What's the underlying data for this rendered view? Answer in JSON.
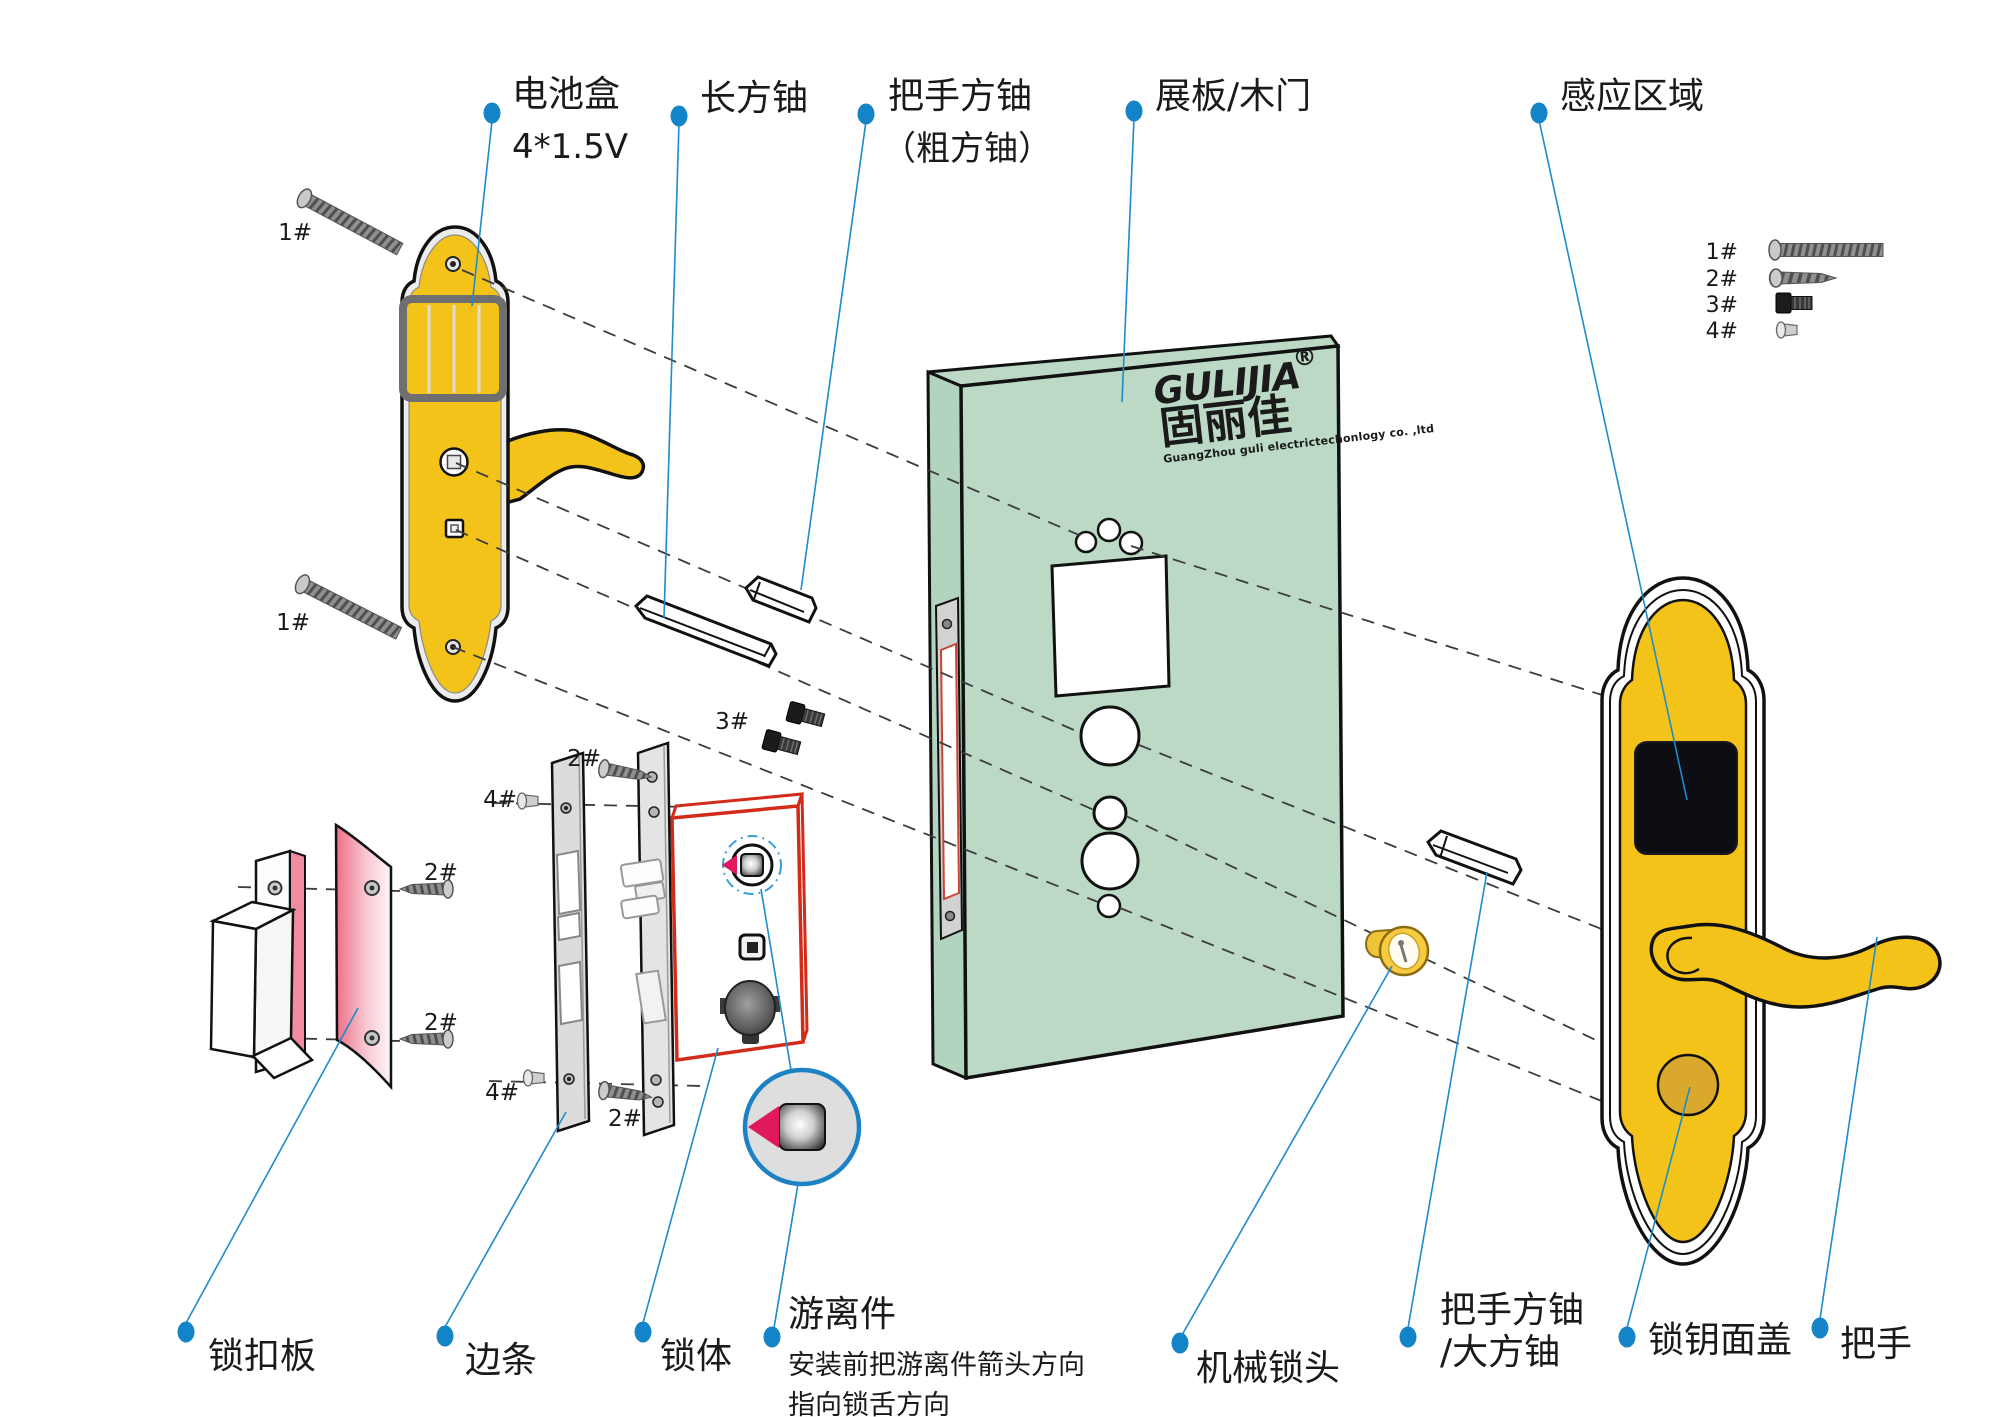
{
  "brand": {
    "name_en": "GULIJIA",
    "reg": "®",
    "name_cn": "固丽佳",
    "company": "GuangZhou guli electrictechonlogy co. ,ltd"
  },
  "labels": {
    "battery_line1": "电池盒",
    "battery_line2": "4*1.5V",
    "long_shaft": "长方铀",
    "handle_shaft_line1": "把手方铀",
    "handle_shaft_line2": "（粗方铀）",
    "door": "展板/木门",
    "sensing_area": "感应区域",
    "strike_plate": "锁扣板",
    "edge_strip": "边条",
    "lock_body": "锁体",
    "floating_title": "游离件",
    "floating_note1": "安装前把游离件箭头方向",
    "floating_note2": "指向锁舌方向",
    "mech_cylinder": "机械锁头",
    "big_shaft_line1": "把手方铀",
    "big_shaft_line2": "/大方铀",
    "key_cover": "锁钥面盖",
    "handle": "把手"
  },
  "legend": {
    "item1": "1#",
    "item2": "2#",
    "item3": "3#",
    "item4": "4#"
  },
  "markers": {
    "screw1_top": "1#",
    "screw1_bottom": "1#",
    "screw2_strike_top": "2#",
    "screw2_strike_bottom": "2#",
    "screw2_faceplate_top": "2#",
    "screw2_faceplate_bottom": "2#",
    "screw3": "3#",
    "screw4_top": "4#",
    "screw4_bottom": "4#"
  },
  "colors": {
    "panel_yellow": "#F4C31A",
    "door_green": "#BBD9C5",
    "logo_yellow": "#F2EE8D",
    "leader_blue": "#1E8BCB",
    "lockbody_red": "#D22B1A",
    "accent_pink": "#E0195A",
    "key_cover_yellow": "#D9A82C"
  }
}
